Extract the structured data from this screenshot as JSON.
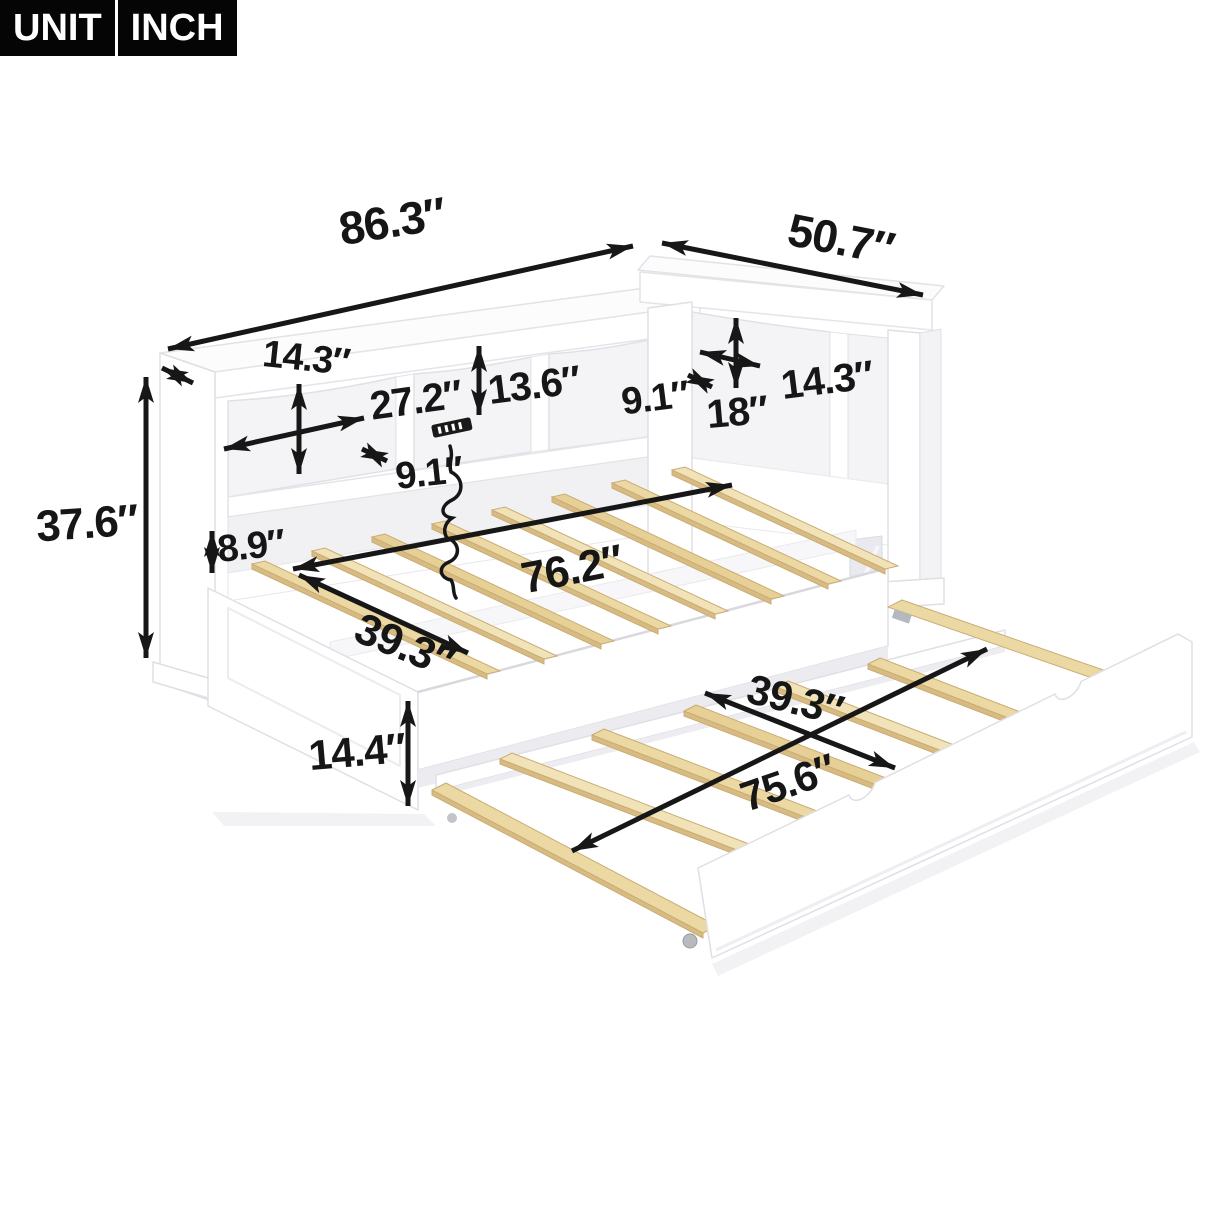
{
  "unit_badge": {
    "label": "UNIT",
    "value": "INCH"
  },
  "dimensions": {
    "overall_length": "86.3″",
    "overall_depth": "50.7″",
    "left_shelf_depth": "14.3″",
    "left_cubby_width": "27.2″",
    "left_cubby_height": "13.6″",
    "left_small_depth": "9.1″",
    "right_small_depth": "9.1″",
    "right_cubby_width": "18″",
    "right_cubby_height": "14.3″",
    "overall_height": "37.6″",
    "lower_shelf_height": "8.9″",
    "slat_length": "76.2″",
    "bed_width": "39.3″",
    "under_bed_height": "14.4″",
    "trundle_width": "39.3″",
    "trundle_length": "75.6″"
  },
  "icons": {
    "outlet": "usb-outlet-icon",
    "cord": "power-cord-icon"
  },
  "colors": {
    "arrow": "#171717",
    "label": "#161616",
    "badge_bg": "#050505",
    "badge_text": "#ffffff",
    "frame_white": "#ffffff",
    "frame_outline": "#e2e2e7",
    "cubby_shadow": "#f4f4f7",
    "wood": "#ecd8a2",
    "wood_dark": "#d8bb82"
  }
}
